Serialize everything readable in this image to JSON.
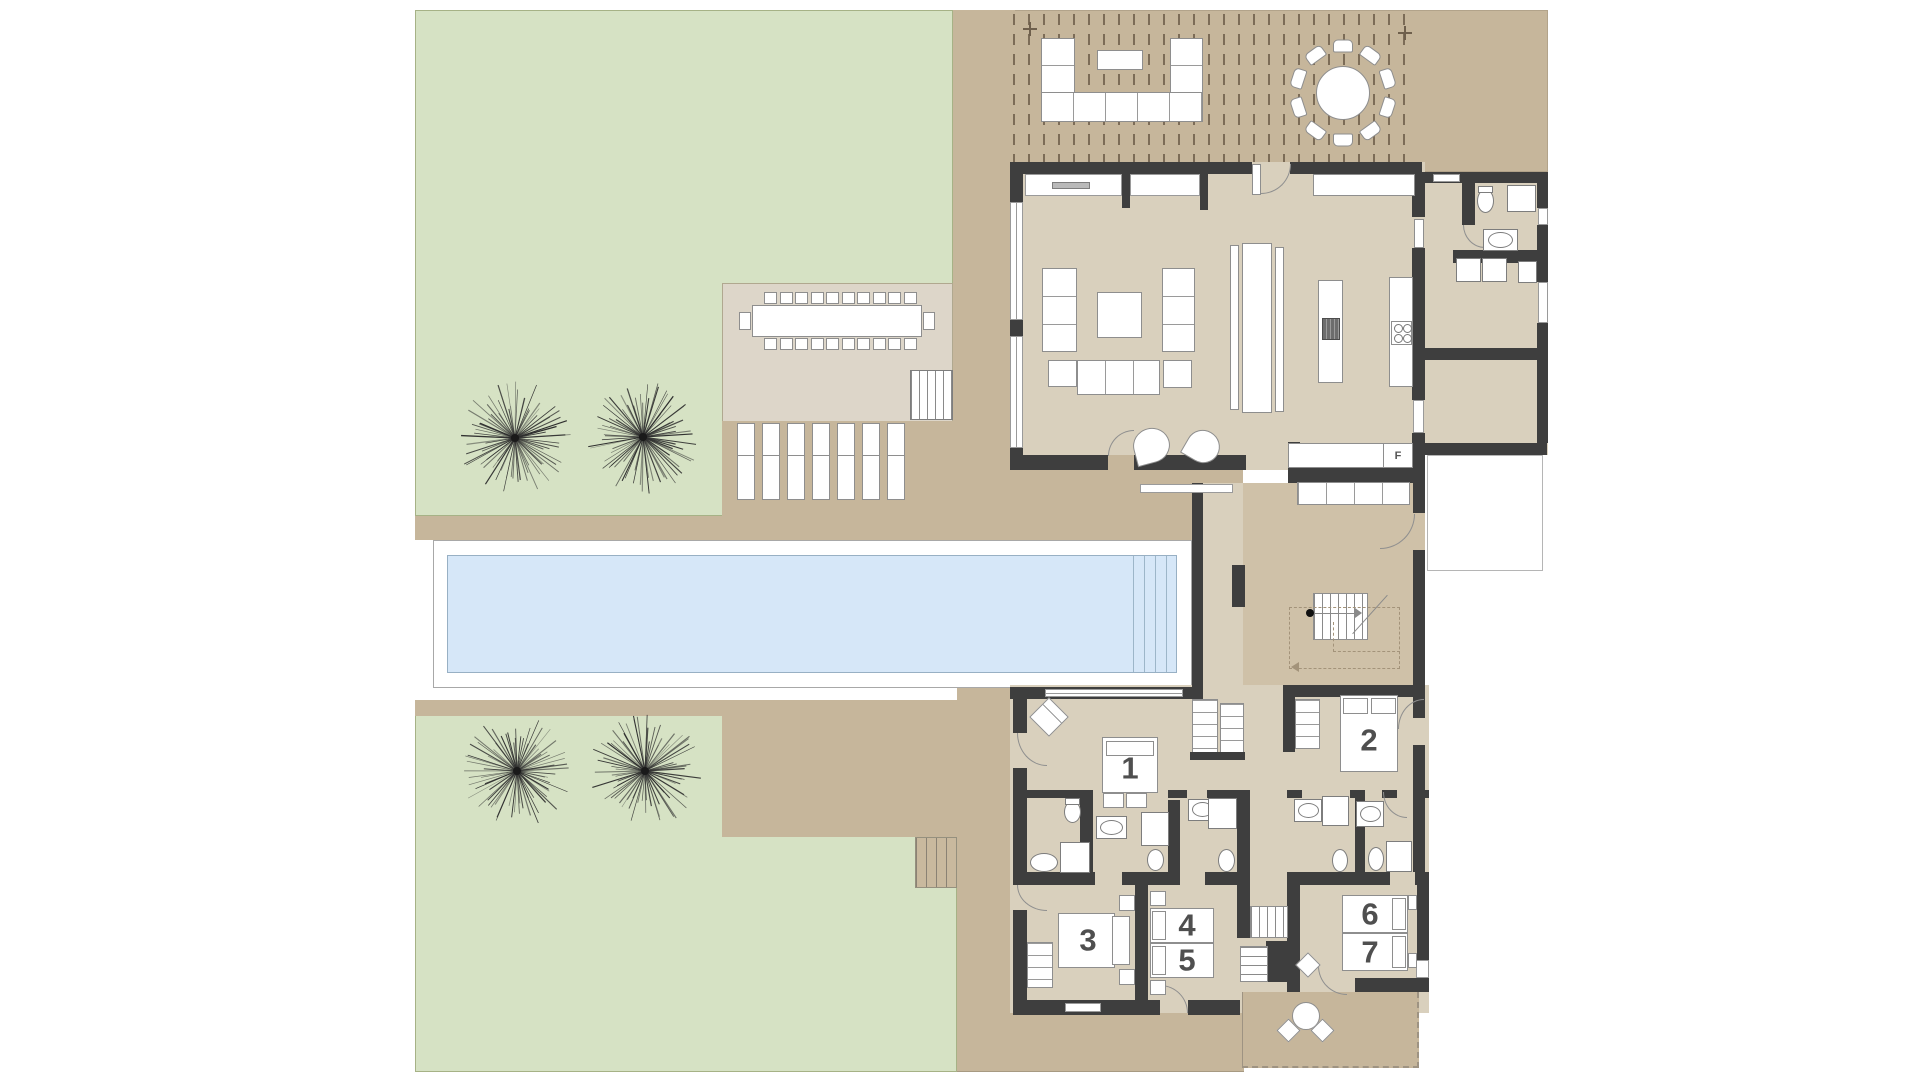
{
  "plan": {
    "type": "architectural-floor-plan",
    "rooms": [
      {
        "id": "bedroom-1",
        "label": "1"
      },
      {
        "id": "bedroom-2",
        "label": "2"
      },
      {
        "id": "bedroom-3",
        "label": "3"
      },
      {
        "id": "bedroom-4",
        "label": "4"
      },
      {
        "id": "bedroom-5",
        "label": "5"
      },
      {
        "id": "bedroom-6",
        "label": "6"
      },
      {
        "id": "bedroom-7",
        "label": "7"
      }
    ],
    "fireplace_label": "F"
  },
  "colors": {
    "lawn_green": "#d6e2c4",
    "lawn_border": "#a6b286",
    "hardscape_tan": "#c6b69b",
    "interior_beige": "#d9d0bd",
    "stair_hall_tan": "#cfc1a8",
    "outdoor_dining_pad": "#ddd6c9",
    "pool_water_blue": "#d6e7f8",
    "pool_edge": "#98b0c4",
    "wall_dark": "#3e3e3e",
    "furniture_white": "#ffffff",
    "label_grey": "#4f4f4f"
  }
}
